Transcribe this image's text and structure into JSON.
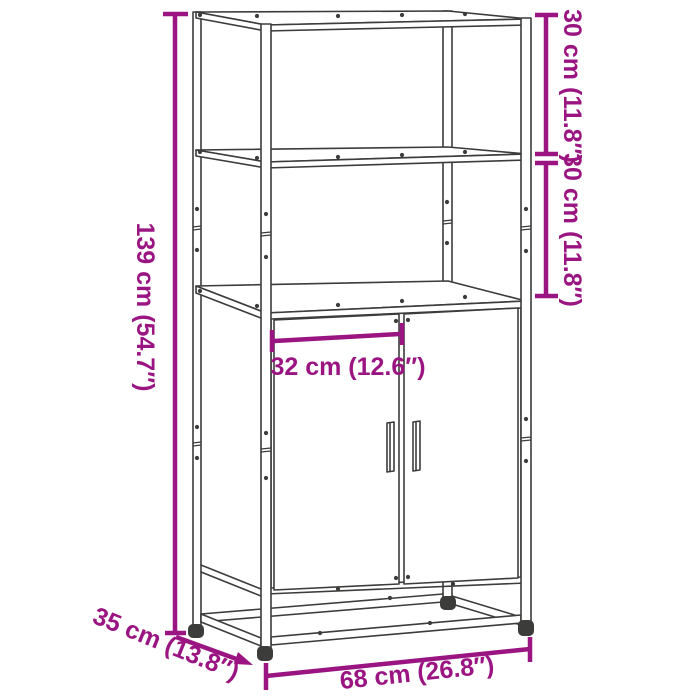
{
  "diagram": {
    "subject": "Technical dimension line drawing of a tall highboard cabinet with two open upper shelves and two lower doors on a metal base frame",
    "style": {
      "background_color": "#FFFFFF",
      "line_color": "#3C3C3B",
      "dimension_color": "#9A1582"
    },
    "dimensions": {
      "total_height": {
        "label": "139 cm (54.7″)",
        "cm": 139,
        "inches": 54.7
      },
      "top_shelf_height": {
        "label": "30 cm (11.8″)",
        "cm": 30,
        "inches": 11.8
      },
      "middle_shelf_height": {
        "label": "30 cm (11.8″)",
        "cm": 30,
        "inches": 11.8
      },
      "inner_width": {
        "label": "32 cm (12.6″)",
        "cm": 32,
        "inches": 12.6
      },
      "depth": {
        "label": "35 cm (13.8″)",
        "cm": 35,
        "inches": 13.8
      },
      "total_width": {
        "label": "68 cm (26.8″)",
        "cm": 68,
        "inches": 26.8
      }
    }
  }
}
